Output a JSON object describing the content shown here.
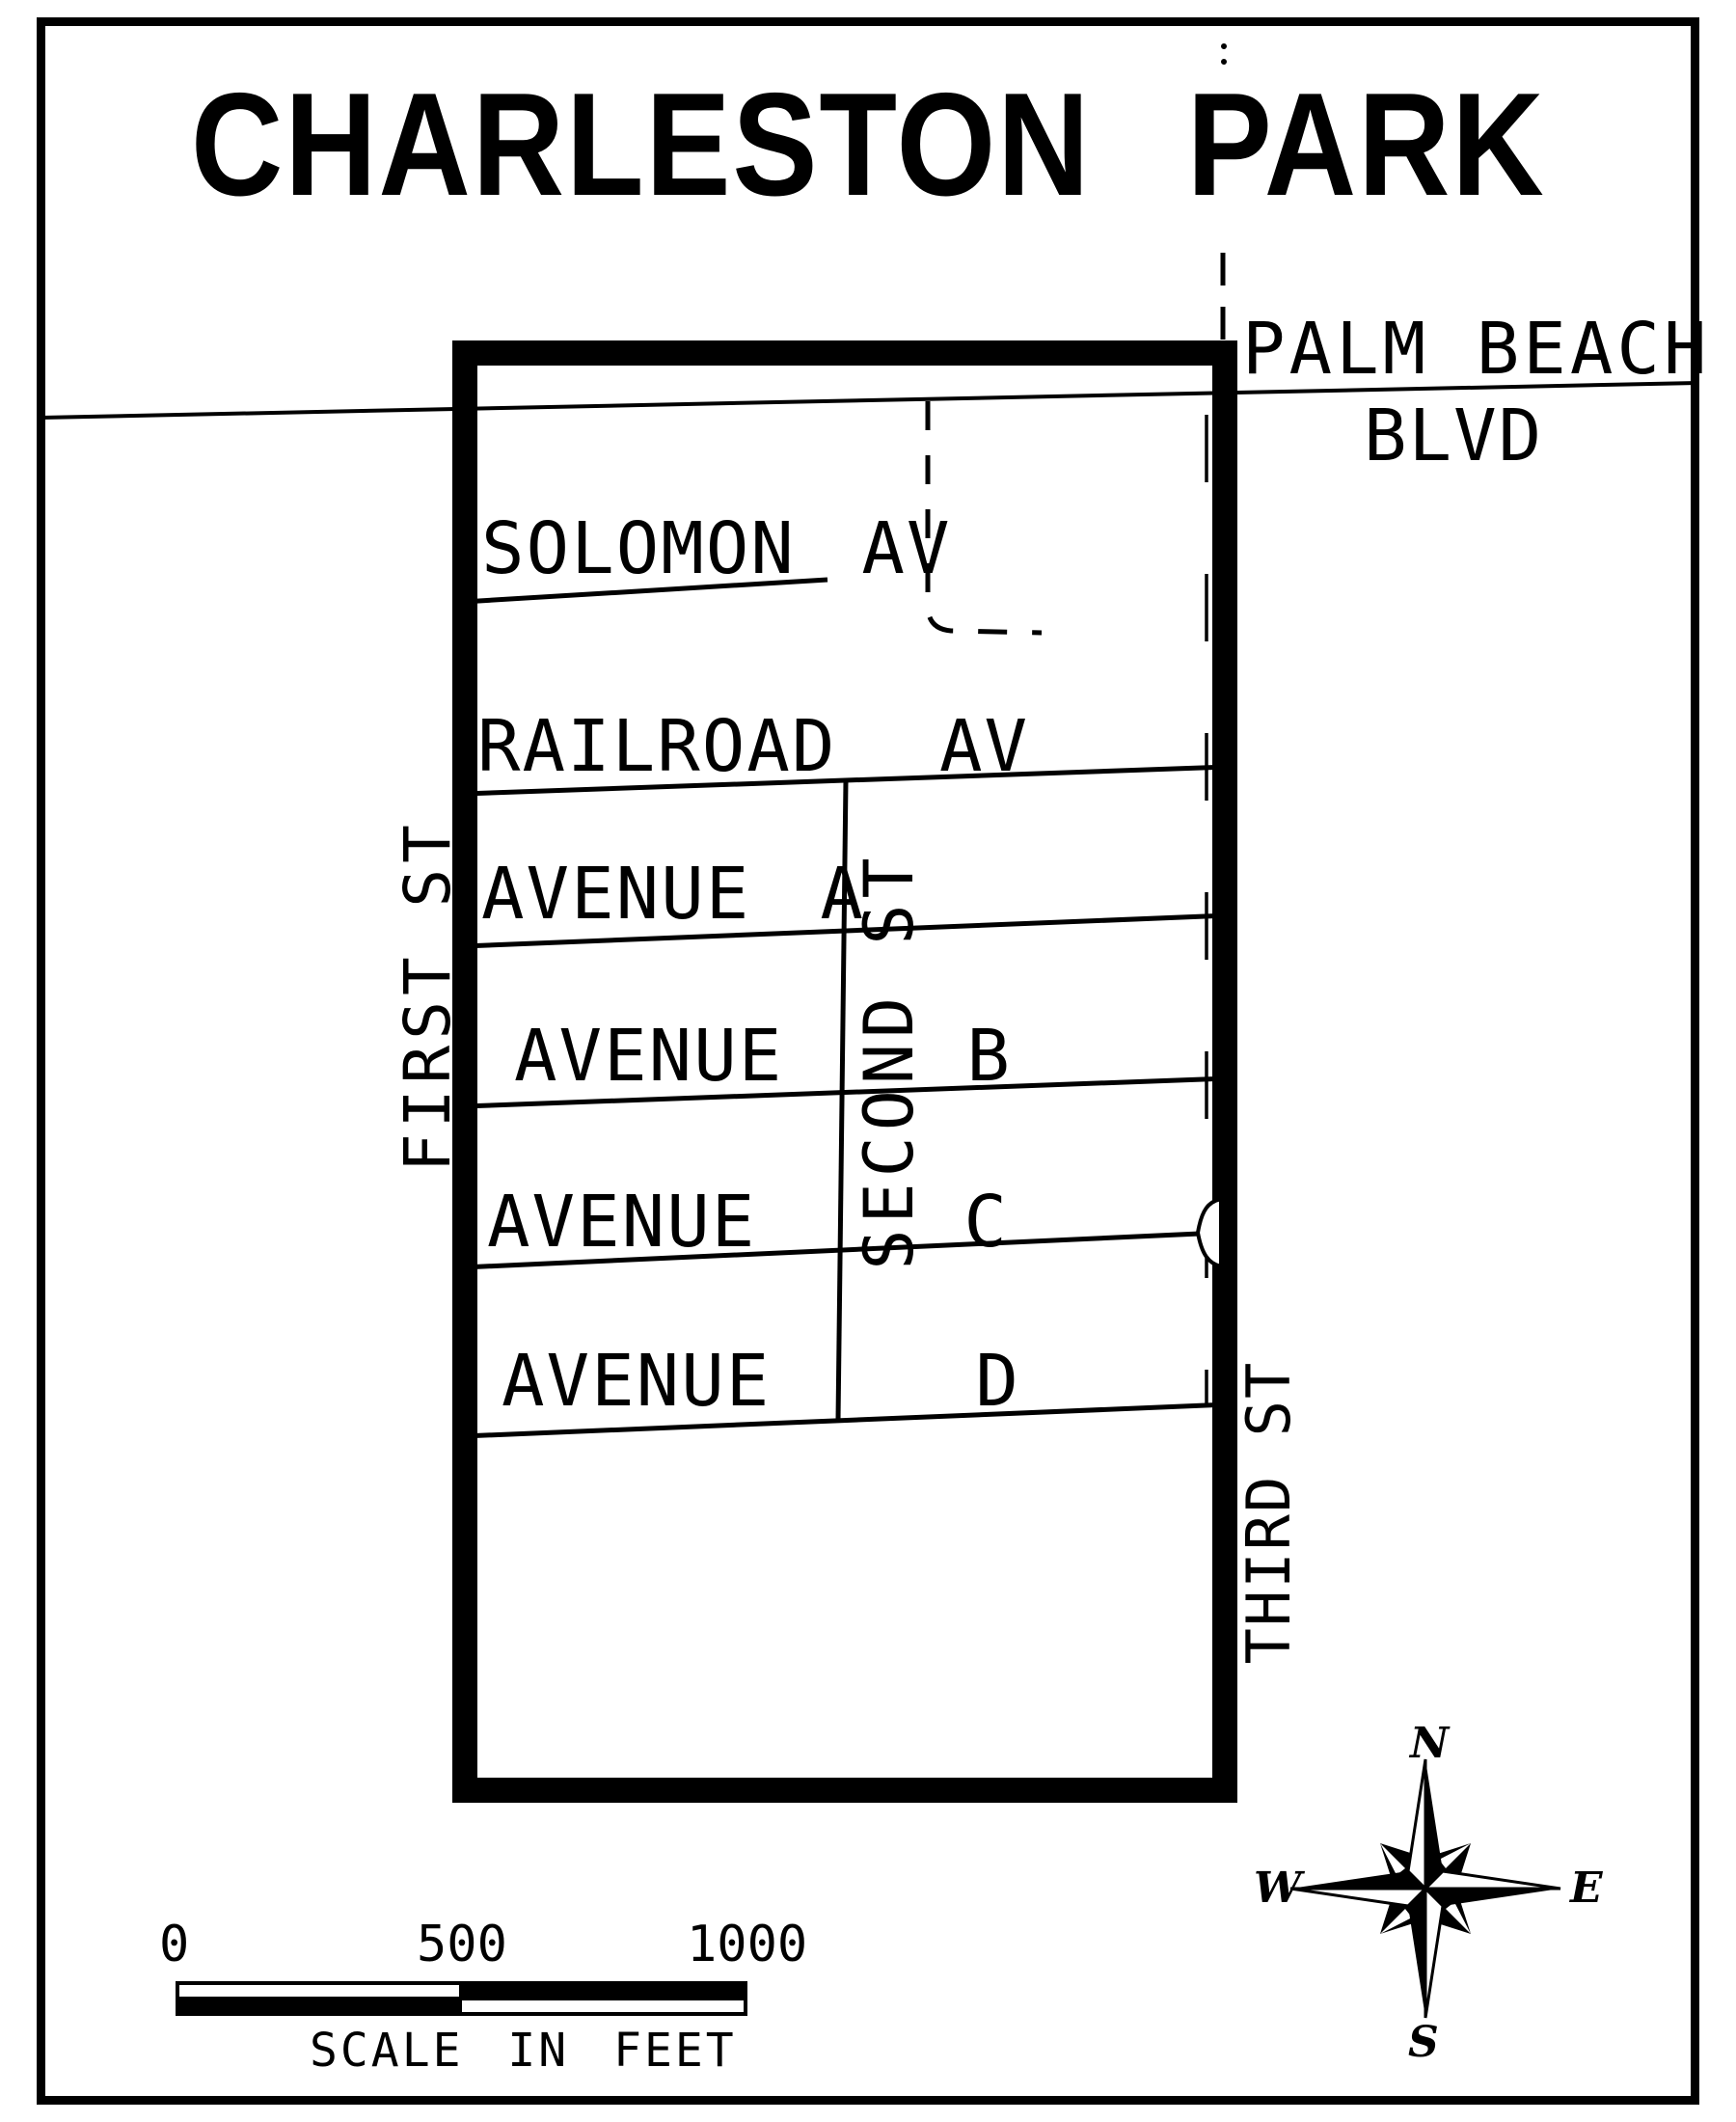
{
  "page": {
    "title": "CHARLESTON PARK"
  },
  "map": {
    "boulevard": {
      "name_line1": "PALM BEACH",
      "name_line2": "BLVD"
    },
    "avenues": {
      "solomon": "SOLOMON AV",
      "railroad": "RAILROAD AV",
      "a": {
        "word": "AVENUE",
        "letter": "A"
      },
      "b": {
        "word": "AVENUE",
        "letter": "B"
      },
      "c": {
        "word": "AVENUE",
        "letter": "C"
      },
      "d": {
        "word": "AVENUE",
        "letter": "D"
      }
    },
    "streets": {
      "first": "FIRST ST",
      "second": "SECOND ST",
      "third": "THIRD ST"
    }
  },
  "scale_bar": {
    "ticks": [
      "0",
      "500",
      "1000"
    ],
    "caption": "SCALE IN FEET"
  },
  "compass": {
    "n": "N",
    "s": "S",
    "e": "E",
    "w": "W"
  },
  "colors": {
    "ink": "#000000",
    "paper": "#ffffff"
  }
}
